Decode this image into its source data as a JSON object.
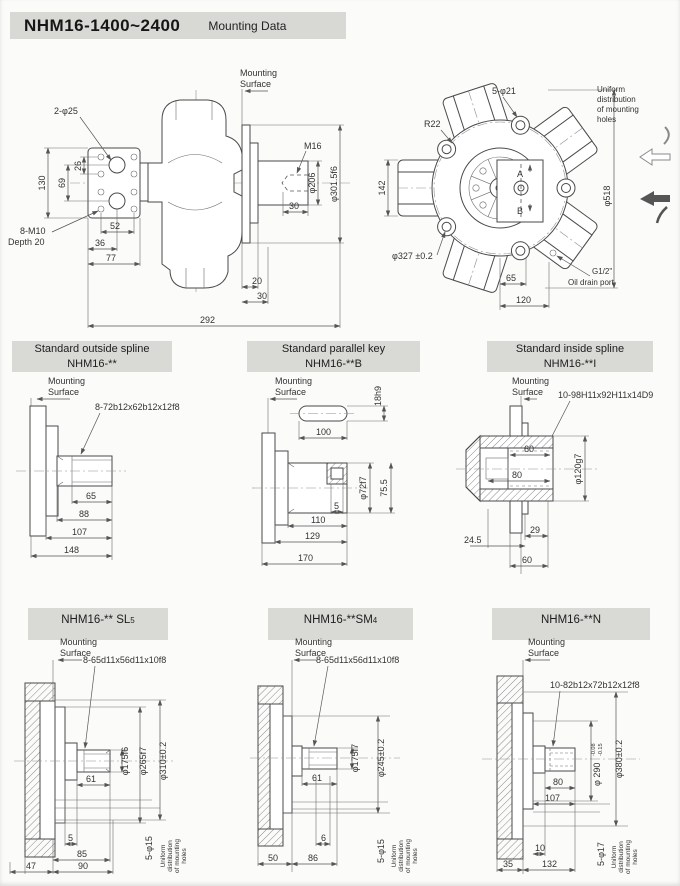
{
  "header": {
    "model": "NHM16-1400~2400",
    "title": "Mounting Data"
  },
  "common": {
    "mounting": "Mounting",
    "surface": "Surface",
    "u1": "Uniform",
    "u2": "distribution",
    "u3": "of mounting",
    "u4": "holes"
  },
  "side": {
    "holes2": "2-φ25",
    "d26": "26",
    "d69": "69",
    "d130": "130",
    "m10": "8-M10",
    "depth": "Depth 20",
    "d52": "52",
    "d36": "36",
    "d77": "77",
    "m16": "M16",
    "d206": "φ206",
    "d301": "φ301.5f6",
    "d30s": "30",
    "d20": "20",
    "d30": "30",
    "d292": "292"
  },
  "front": {
    "holes5": "5-φ21",
    "r22": "R22",
    "d142": "142",
    "d518": "φ518",
    "d327": "φ327 ±0.2",
    "d65": "65",
    "d120": "120",
    "g12": "G1/2\"",
    "drain": "Oil drain port",
    "a": "A",
    "b": "B"
  },
  "m1": {
    "h1": "Standard outside spline",
    "h2": "NHM16-**",
    "spec": "8-72b12x62b12x12f8",
    "d65": "65",
    "d88": "88",
    "d107": "107",
    "d148": "148"
  },
  "m2": {
    "h1": "Standard parallel key",
    "h2": "NHM16-**B",
    "key": "18h9",
    "d100": "100",
    "dia": "φ72f7",
    "d755": "75.5",
    "d5": "5",
    "d110": "110",
    "d129": "129",
    "d170": "170"
  },
  "m3": {
    "h1": "Standard inside spline",
    "h2": "NHM16-**I",
    "spec": "10-98H11x92H11x14D9",
    "d60i": "60",
    "d80": "80",
    "dia": "φ120g7",
    "d29": "29",
    "d245": "24.5",
    "d60": "60"
  },
  "b1": {
    "h": "NHM16-** SL",
    "hs": "5",
    "spec": "8-65d11x56d11x10f8",
    "d61": "61",
    "dia1": "φ175f6",
    "dia2": "φ265f7",
    "dia3": "φ310±0.2",
    "d5": "5",
    "d85": "85",
    "d90": "90",
    "d47": "47",
    "holes": "5-φ15"
  },
  "b2": {
    "h": "NHM16-**SM",
    "hs": "4",
    "spec": "8-65d11x56d11x10f8",
    "d61": "61",
    "dia1": "φ175f7",
    "dia2": "φ245±0.2",
    "d6": "6",
    "d86": "86",
    "d50": "50",
    "holes": "5-φ15"
  },
  "b3": {
    "h": "NHM16-**N",
    "spec": "10-82b12x72b12x12f8",
    "d80": "80",
    "d107": "107",
    "dia1": "φ 290",
    "tol1": "-0.08",
    "tol2": "-0.15",
    "dia2": "φ380±0.2",
    "d10": "10",
    "d132": "132",
    "d35": "35",
    "holes": "5-φ17"
  }
}
